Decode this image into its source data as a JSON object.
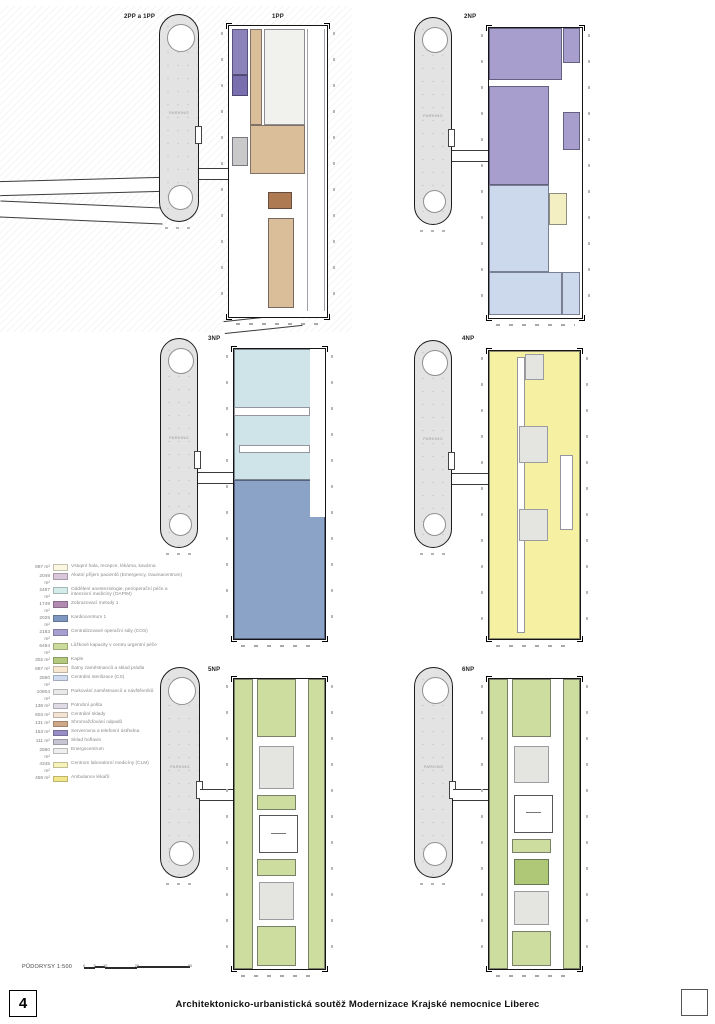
{
  "sheet": {
    "page_number": "4",
    "title": "Architektonicko-urbanistická soutěž Modernizace Krajské nemocnice Liberec",
    "scale_label": "PŮDORYSY 1:500",
    "scale_ticks": [
      {
        "text": "0",
        "pos": 0
      },
      {
        "text": "5",
        "pos": 10
      },
      {
        "text": "10",
        "pos": 20
      },
      {
        "text": "25",
        "pos": 50
      },
      {
        "text": "50",
        "pos": 100
      }
    ]
  },
  "colors": {
    "purple": "#8d83bb",
    "purpleDark": "#7a6fae",
    "grayRoom": "#c9c9c9",
    "tan": "#dabd99",
    "hall": "#f1f1ee",
    "brown": "#ad7a52",
    "violet": "#a79ecd",
    "blue": "#ccd9ed",
    "yellowBlk": "#f3efc3",
    "cyan": "#cfe4e9",
    "steel": "#8ba3c7",
    "yellow4": "#f5f0a2",
    "grayTech": "#e4e4e1",
    "green": "#cddc9f",
    "greenDark": "#aec878",
    "white": "#ffffff",
    "towerFill": "#e3e3e3"
  },
  "legend": {
    "items": [
      {
        "area": "697 m²",
        "color": "#faf7e3",
        "label": "Vstupní hala, recepce, lékárna, kavárna"
      },
      {
        "area": "2049 m²",
        "color": "#d9c6da",
        "label": "Akutní příjem pacientů (Emergency, traumacentrum)"
      },
      {
        "area": "2467 m²",
        "color": "#d4ecea",
        "label": "Oddělení anesteziologie, perioperační péče a intenzivní medicíny (OAPIM)"
      },
      {
        "area": "1749 m²",
        "color": "#b18bb1",
        "label": "Zobrazovací metody 1"
      },
      {
        "area": "2025 m²",
        "color": "#7e97c0",
        "label": "Kardiocentrum 1"
      },
      {
        "area": "2183 m²",
        "color": "#a89fd1",
        "label": "Centralizované operační sály (COS)"
      },
      {
        "area": "6494 m²",
        "color": "#cbdb9c",
        "label": "Lůžkové kapacity v centru urgentní péče"
      },
      {
        "area": "302 m²",
        "color": "#b4c97d",
        "label": "Kaple"
      },
      {
        "area": "697 m²",
        "color": "#f7e7d0",
        "label": "Šatny zaměstnanců a sklad prádla"
      },
      {
        "area": "2550 m²",
        "color": "#cfdcf0",
        "label": "Centrální sterilizace (CS)"
      },
      {
        "area": "10804 m²",
        "color": "#e9e9e9",
        "label": "Parkování zaměstnanců a návštěvníků"
      },
      {
        "area": "138 m²",
        "color": "#dedbe7",
        "label": "Potrubní pošta"
      },
      {
        "area": "603 m²",
        "color": "#f3e4d4",
        "label": "Centrální sklady"
      },
      {
        "area": "131 m²",
        "color": "#cda988",
        "label": "Shromažďování odpadů"
      },
      {
        "area": "153 m²",
        "color": "#998dc5",
        "label": "Serverovna a telefonní ústředna"
      },
      {
        "area": "111 m²",
        "color": "#c7c5d4",
        "label": "Sklad hořlavin"
      },
      {
        "area": "2580 m²",
        "color": "#efefef",
        "label": "Energocentrum"
      },
      {
        "area": "4345 m²",
        "color": "#f7f2b9",
        "label": "Centrum laboratorní medicíny (CLM)"
      },
      {
        "area": "459 m²",
        "color": "#f1e78a",
        "label": "Ambulance lékařů"
      }
    ]
  },
  "plans": [
    {
      "id": "1pp",
      "label": "1PP",
      "label_x": 272,
      "label_y": 14,
      "extra_label": {
        "text": "2PP a 1PP",
        "x": 124,
        "y": 14
      },
      "tower": {
        "x": 159,
        "y": 14,
        "w": 40,
        "h": 208,
        "label": "PARKING"
      },
      "link_frac": 0.74,
      "plan": {
        "x": 228,
        "y": 25,
        "w": 100,
        "h": 293
      },
      "zones": [
        {
          "x": 3,
          "y": 1,
          "w": 16,
          "h": 16,
          "c": "purple",
          "p": "rooms"
        },
        {
          "x": 3,
          "y": 17,
          "w": 16,
          "h": 7,
          "c": "purpleDark",
          "p": "rooms"
        },
        {
          "x": 3,
          "y": 38,
          "w": 16,
          "h": 10,
          "c": "grayRoom",
          "p": "rooms"
        },
        {
          "x": 21,
          "y": 1,
          "w": 13,
          "h": 33,
          "c": "tan",
          "p": "rooms"
        },
        {
          "x": 36,
          "y": 1,
          "w": 42,
          "h": 33,
          "c": "hall",
          "p": "plain"
        },
        {
          "x": 21,
          "y": 34,
          "w": 57,
          "h": 17,
          "c": "tan",
          "p": "rooms"
        },
        {
          "x": 80,
          "y": 1,
          "w": 18,
          "h": 97,
          "c": "white",
          "p": "stripesTan"
        },
        {
          "x": 40,
          "y": 57,
          "w": 24,
          "h": 6,
          "c": "brown",
          "p": "plain"
        },
        {
          "x": 40,
          "y": 66,
          "w": 26,
          "h": 31,
          "c": "tan",
          "p": "parking"
        }
      ]
    },
    {
      "id": "2np",
      "label": "2NP",
      "label_x": 464,
      "label_y": 14,
      "tower": {
        "x": 414,
        "y": 17,
        "w": 38,
        "h": 208,
        "label": "PARKING"
      },
      "link_frac": 0.64,
      "plan": {
        "x": 488,
        "y": 27,
        "w": 95,
        "h": 292
      },
      "zones": [
        {
          "x": 0,
          "y": 0,
          "w": 79,
          "h": 18,
          "c": "violet",
          "p": "rooms"
        },
        {
          "x": 0,
          "y": 20,
          "w": 64,
          "h": 34,
          "c": "violet",
          "p": "rooms"
        },
        {
          "x": 80,
          "y": 0,
          "w": 18,
          "h": 12,
          "c": "violet",
          "p": "rooms"
        },
        {
          "x": 80,
          "y": 29,
          "w": 18,
          "h": 13,
          "c": "violet",
          "p": "rooms"
        },
        {
          "x": 0,
          "y": 54,
          "w": 64,
          "h": 30,
          "c": "blue",
          "p": "rooms"
        },
        {
          "x": 0,
          "y": 84,
          "w": 78,
          "h": 15,
          "c": "blue",
          "p": "rooms"
        },
        {
          "x": 78,
          "y": 84,
          "w": 20,
          "h": 15,
          "c": "blue",
          "p": "rooms"
        },
        {
          "x": 64,
          "y": 57,
          "w": 20,
          "h": 11,
          "c": "yellowBlk",
          "p": "plain"
        }
      ]
    },
    {
      "id": "3np",
      "label": "3NP",
      "label_x": 208,
      "label_y": 336,
      "tower": {
        "x": 160,
        "y": 338,
        "w": 38,
        "h": 210,
        "label": "PARKING"
      },
      "link_frac": 0.64,
      "plan": {
        "x": 233,
        "y": 348,
        "w": 93,
        "h": 292
      },
      "zones": [
        {
          "x": 0,
          "y": 0,
          "w": 100,
          "h": 45,
          "c": "cyan",
          "p": "rooms"
        },
        {
          "x": 0,
          "y": 45,
          "w": 100,
          "h": 55,
          "c": "steel",
          "p": "rooms"
        },
        {
          "x": 84,
          "y": 0,
          "w": 16,
          "h": 58,
          "c": "white",
          "p": "wstripe"
        },
        {
          "x": 0,
          "y": 20,
          "w": 84,
          "h": 3,
          "c": "white",
          "p": "plain"
        },
        {
          "x": 6,
          "y": 33,
          "w": 78,
          "h": 3,
          "c": "white",
          "p": "plain"
        }
      ]
    },
    {
      "id": "4np",
      "label": "4NP",
      "label_x": 462,
      "label_y": 336,
      "tower": {
        "x": 414,
        "y": 340,
        "w": 38,
        "h": 208,
        "label": "PARKING"
      },
      "link_frac": 0.64,
      "plan": {
        "x": 488,
        "y": 350,
        "w": 93,
        "h": 290
      },
      "zones": [
        {
          "x": 0,
          "y": 0,
          "w": 100,
          "h": 100,
          "c": "yellow4",
          "p": "rooms"
        },
        {
          "x": 31,
          "y": 2,
          "w": 9,
          "h": 96,
          "c": "white",
          "p": "plain"
        },
        {
          "x": 40,
          "y": 1,
          "w": 20,
          "h": 9,
          "c": "grayTech",
          "p": "tech"
        },
        {
          "x": 33,
          "y": 26,
          "w": 32,
          "h": 13,
          "c": "grayTech",
          "p": "tech"
        },
        {
          "x": 33,
          "y": 55,
          "w": 32,
          "h": 11,
          "c": "grayTech",
          "p": "tech"
        },
        {
          "x": 78,
          "y": 36,
          "w": 14,
          "h": 26,
          "c": "white",
          "p": "rooms"
        }
      ]
    },
    {
      "id": "5np",
      "label": "5NP",
      "label_x": 208,
      "label_y": 667,
      "tower": {
        "x": 160,
        "y": 667,
        "w": 40,
        "h": 211,
        "label": "PARKING"
      },
      "link_frac": 0.58,
      "plan": {
        "x": 233,
        "y": 678,
        "w": 93,
        "h": 292
      },
      "zones": [
        {
          "x": 0,
          "y": 0,
          "w": 21,
          "h": 100,
          "c": "green",
          "p": "rooms"
        },
        {
          "x": 81,
          "y": 0,
          "w": 19,
          "h": 100,
          "c": "green",
          "p": "rooms"
        },
        {
          "x": 25,
          "y": 0,
          "w": 43,
          "h": 20,
          "c": "green",
          "p": "rooms"
        },
        {
          "x": 28,
          "y": 23,
          "w": 38,
          "h": 15,
          "c": "grayTech",
          "p": "tech"
        },
        {
          "x": 25,
          "y": 40,
          "w": 43,
          "h": 5,
          "c": "green",
          "p": "rooms"
        },
        {
          "x": 28,
          "y": 47,
          "w": 42,
          "h": 13,
          "c": "white",
          "p": "atrium"
        },
        {
          "x": 25,
          "y": 62,
          "w": 43,
          "h": 6,
          "c": "green",
          "p": "rooms"
        },
        {
          "x": 28,
          "y": 70,
          "w": 38,
          "h": 13,
          "c": "grayTech",
          "p": "tech"
        },
        {
          "x": 25,
          "y": 85,
          "w": 43,
          "h": 14,
          "c": "green",
          "p": "rooms"
        }
      ]
    },
    {
      "id": "6np",
      "label": "6NP",
      "label_x": 462,
      "label_y": 667,
      "tower": {
        "x": 414,
        "y": 667,
        "w": 39,
        "h": 211,
        "label": "PARKING"
      },
      "link_frac": 0.58,
      "plan": {
        "x": 488,
        "y": 678,
        "w": 93,
        "h": 292
      },
      "zones": [
        {
          "x": 0,
          "y": 0,
          "w": 21,
          "h": 100,
          "c": "green",
          "p": "rooms"
        },
        {
          "x": 81,
          "y": 0,
          "w": 19,
          "h": 100,
          "c": "green",
          "p": "rooms"
        },
        {
          "x": 25,
          "y": 0,
          "w": 43,
          "h": 20,
          "c": "green",
          "p": "rooms"
        },
        {
          "x": 28,
          "y": 23,
          "w": 38,
          "h": 13,
          "c": "grayTech",
          "p": "tech"
        },
        {
          "x": 28,
          "y": 40,
          "w": 42,
          "h": 13,
          "c": "white",
          "p": "atrium"
        },
        {
          "x": 25,
          "y": 55,
          "w": 43,
          "h": 5,
          "c": "green",
          "p": "rooms"
        },
        {
          "x": 28,
          "y": 62,
          "w": 38,
          "h": 9,
          "c": "greenDark",
          "p": "plain"
        },
        {
          "x": 28,
          "y": 73,
          "w": 38,
          "h": 12,
          "c": "grayTech",
          "p": "tech"
        },
        {
          "x": 25,
          "y": 87,
          "w": 43,
          "h": 12,
          "c": "green",
          "p": "rooms"
        }
      ]
    }
  ]
}
